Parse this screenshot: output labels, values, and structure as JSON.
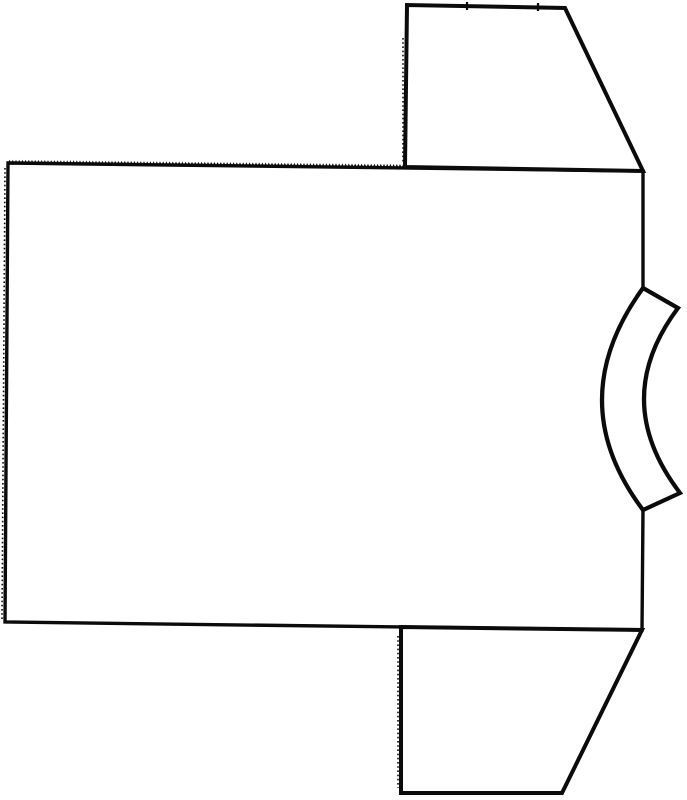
{
  "canvas": {
    "width": 687,
    "height": 800,
    "background": "#ffffff",
    "ink": "#0b0b0b"
  },
  "drawing": {
    "description": "Flat black-line drawing of a short-sleeved T-shirt pattern laid horizontally: rectangular body panel, trapezoid sleeves at upper-right and lower-right, curved crescent neckband on the right edge, pinked zigzag top edge and rough serrated cut edges.",
    "pieces": {
      "body": {
        "name": "body-panel",
        "path": "M 8 163 L 643 171 L 643 288 Q 561 401 643 510 L 642 630 L 5 622 Z"
      },
      "top_sleeve": {
        "name": "top-sleeve",
        "path": "M 405 167 L 407 5 L 565 8 L 643 171 Z"
      },
      "bottom_sleeve": {
        "name": "bottom-sleeve",
        "path": "M 401 627 L 401 793 L 562 793 L 642 630 Z"
      },
      "neckband": {
        "name": "neckband-crescent",
        "path": "M 643 288 L 678 308 Q 609 400 680 493 L 643 510 Q 561 401 643 288 Z"
      },
      "notches": {
        "name": "sleeve-notch-ticks",
        "path": "M 467 2 L 467 10 M 538 3 L 538 11"
      }
    },
    "textures": {
      "zigzag_top_edge": {
        "from": [
          8,
          163
        ],
        "to": [
          405,
          167.5
        ],
        "pitch": 3.2,
        "amplitude": 3.4
      },
      "rough_edges": [
        {
          "name": "body-left-edge-serration",
          "path": "M 5 168 L 2 620"
        },
        {
          "name": "top-sleeve-left-edge-serration",
          "path": "M 403 38 L 403 164"
        },
        {
          "name": "bottom-sleeve-left-edge-serration",
          "path": "M 398 636 L 398 788"
        },
        {
          "name": "neckband-inner-edge-serration",
          "path": "M 640 294 Q 563 401 640 504"
        },
        {
          "name": "neckband-outer-edge-serration",
          "path": "M 674 313 Q 612 400 675 488"
        }
      ]
    }
  }
}
